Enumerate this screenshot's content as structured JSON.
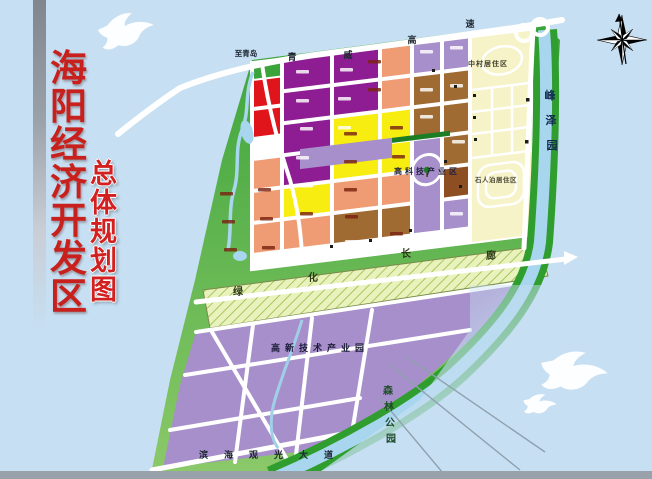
{
  "title": {
    "main": "海阳经济开发区",
    "sub": "总体规划图"
  },
  "map": {
    "road_labels": {
      "to_qingdao": "至青岛"
    },
    "expressway_chars": [
      "青",
      "威",
      "高",
      "速"
    ],
    "corridor_chars": [
      "绿",
      "化",
      "长",
      "廊"
    ],
    "areas": {
      "zhongcun": "中村居住区",
      "shirenpo": "石人泊居住区",
      "hightech_zone": "高科技产业区",
      "hightech_park": "高新技术产业园",
      "coastal_avenue": "滨海观光大道"
    },
    "fengzeyuan_chars": [
      "峰",
      "泽",
      "园"
    ],
    "forest_chars": [
      "森",
      "林",
      "公",
      "园"
    ]
  },
  "colors": {
    "sea": "#c6dff2",
    "belt": "#3aa339",
    "purple": "#8e1d94",
    "red": "#e0151b",
    "yellow": "#f8ed10",
    "salmon": "#ef9c74",
    "brown": "#a06a33",
    "darkbrown": "#8d4e22",
    "lavender": "#a78fcb",
    "cream": "#f7f3c8",
    "hatch": "#e9f2bc",
    "river": "#a8d6ee",
    "road": "#ffffff",
    "titlered": "#c8201c",
    "bargray": "#99a1ab"
  }
}
